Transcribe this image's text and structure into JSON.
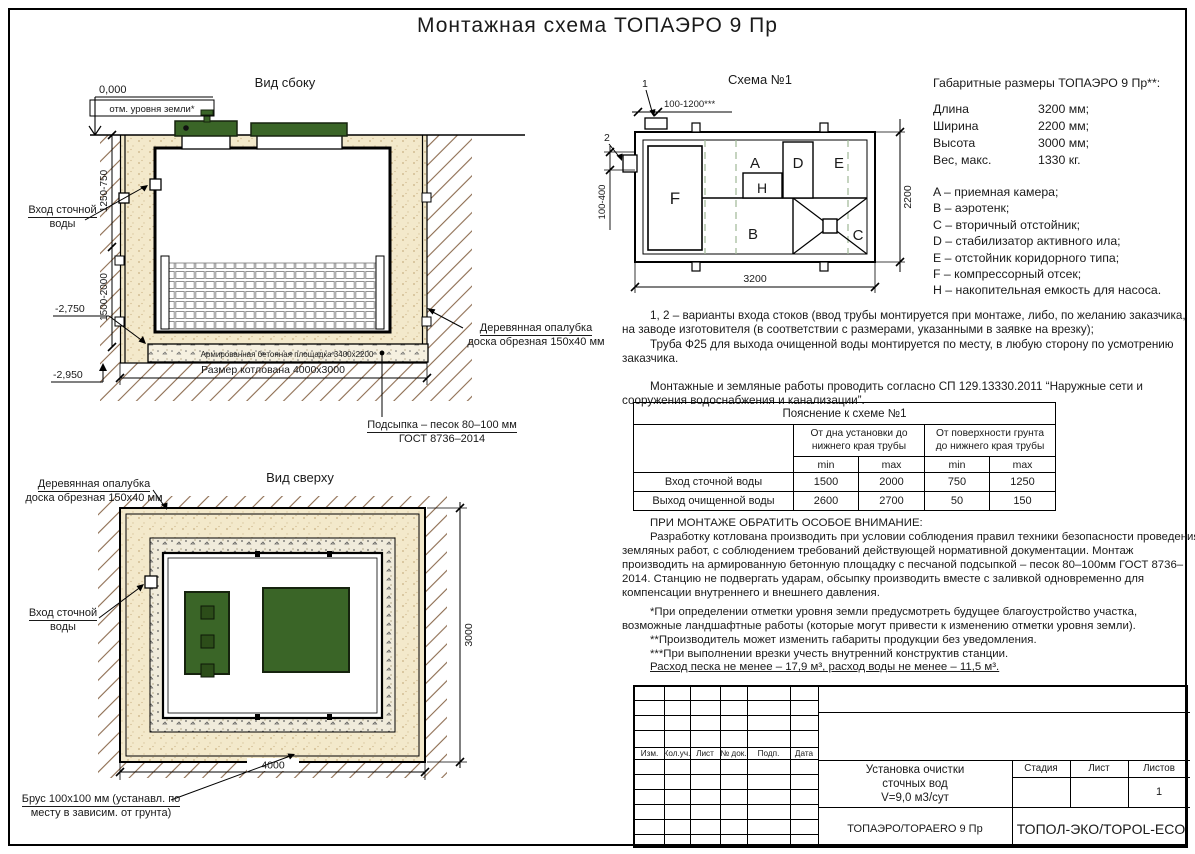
{
  "sheet": {
    "title": "Монтажная схема ТОПАЭРО 9 Пр"
  },
  "labels": {
    "formwork_l1": "Деревянная опалубка",
    "formwork_l2": "доска обрезная 150x40 мм",
    "inlet_l1": "Вход сточной",
    "inlet_l2": "воды"
  },
  "side_view": {
    "title": "Вид сбоку",
    "elev_zero": "0,000",
    "ground_note": "отм. уровня земли*",
    "dim_upper": "1250-750",
    "dim_lower": "1500-2000",
    "elev_slab": "-2,750",
    "elev_bottom": "-2,950",
    "slab_label": "Армированная бетонная площадка 3400x2200",
    "pit_dim": "Размер котлована 4000x3000",
    "bedding_l1": "Подсыпка – песок 80–100 мм",
    "bedding_l2": "ГОСТ 8736–2014"
  },
  "scheme": {
    "title": "Схема №1",
    "marker1": "1",
    "marker2": "2",
    "dim_top": "100-1200***",
    "dim_side": "100-400",
    "dim_width": "3200",
    "dim_height": "2200",
    "comp_a": "A",
    "comp_b": "B",
    "comp_c": "C",
    "comp_d": "D",
    "comp_e": "E",
    "comp_f": "F",
    "comp_h": "H"
  },
  "dims": {
    "heading": "Габаритные размеры ТОПАЭРО 9 Пр**:",
    "specs": [
      {
        "label": "Длина",
        "value": "3200 мм;"
      },
      {
        "label": "Ширина",
        "value": "2200 мм;"
      },
      {
        "label": "Высота",
        "value": "3000 мм;"
      },
      {
        "label": "Вес, макс.",
        "value": "1330 кг."
      }
    ],
    "legend": [
      "A – приемная камера;",
      "B – аэротенк;",
      "C – вторичный отстойник;",
      "D – стабилизатор активного ила;",
      "E – отстойник коридорного типа;",
      "F – компрессорный отсек;",
      "H – накопительная емкость для насоса."
    ]
  },
  "notes": {
    "p1": "1, 2 – варианты входа  стоков (ввод трубы монтируется при монтаже, либо, по желанию заказчика, на заводе изготовителя (в соответствии с размерами, указанными в заявке на врезку);",
    "p2": "Труба Ф25 для выхода очищенной воды монтируется по месту, в любую сторону по усмотрению заказчика.",
    "p3": "Монтажные и земляные работы проводить согласно СП 129.13330.2011 “Наружные сети и сооружения водоснабжения и канализации”."
  },
  "explain": {
    "title": "Пояснение к схеме №1",
    "group1": "От дна установки до\nнижнего края трубы",
    "group2": "От поверхности грунта\nдо нижнего края трубы",
    "min": "min",
    "max": "max",
    "rows": [
      [
        "Вход сточной воды",
        "1500",
        "2000",
        "750",
        "1250"
      ],
      [
        "Выход очищенной воды",
        "2600",
        "2700",
        "50",
        "150"
      ]
    ]
  },
  "attention": {
    "heading": "ПРИ МОНТАЖЕ ОБРАТИТЬ ОСОБОЕ ВНИМАНИЕ:",
    "body": "Разработку котлована производить при условии соблюдения правил техники безопасности проведения земляных работ, с соблюдением требований действующей нормативной документации.  Монтаж производить на армированную бетонную площадку с песчаной подсыпкой – песок 80–100мм ГОСТ 8736–2014. Станцию не подвергать ударам, обсыпку производить вместе с заливкой одновременно для компенсации внутреннего и внешнего давления.",
    "note1": "*При определении отметки уровня земли предусмотреть будущее благоустройство участка, возможные ландшафтные работы (которые могут привести к изменению отметки уровня земли).",
    "note2": "**Производитель может изменить габариты продукции без уведомления.",
    "note3": "***При выполнении врезки учесть внутренний конструктив станции.",
    "consumption": "Расход песка не менее – 17,9 м³, расход воды не менее – 11,5 м³."
  },
  "top_view": {
    "title": "Вид сверху",
    "beam_l1": "Брус 100x100 мм (устанавл. по",
    "beam_l2": "месту в зависим. от грунта)",
    "dim_w": "4000",
    "dim_h": "3000"
  },
  "title_block": {
    "cols": [
      "Изм.",
      "Кол.уч.",
      "Лист",
      "№ док.",
      "Подп.",
      "Дата"
    ],
    "doc_title_l1": "Установка очистки",
    "doc_title_l2": "сточных вод",
    "doc_title_l3": "V=9,0 м3/сут",
    "stage": "Стадия",
    "sheet": "Лист",
    "sheets": "Листов",
    "sheets_value": "1",
    "model": "ТОПАЭРО/TOPAERO 9 Пр",
    "company": "ТОПОЛ-ЭКО/TOPOL-ECO"
  },
  "colors": {
    "sand": "#f3e9cb",
    "green": "#3a6527",
    "line": "#000000"
  }
}
